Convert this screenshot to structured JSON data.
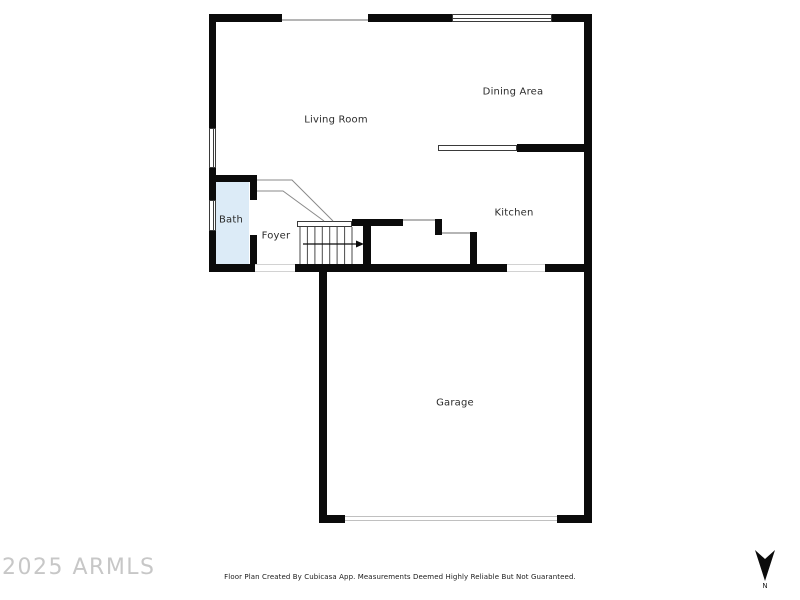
{
  "rooms": [
    {
      "label": "Living Room"
    },
    {
      "label": "Dining Area"
    },
    {
      "label": "Kitchen"
    },
    {
      "label": "Bath"
    },
    {
      "label": "Foyer"
    },
    {
      "label": "Garage"
    }
  ],
  "watermark": "2025 ARMLS",
  "disclaimer": "Floor Plan Created By Cubicasa App. Measurements Deemed Highly Reliable But Not Guaranteed.",
  "compass": {
    "label": "N"
  },
  "colors": {
    "wall": "#0b0b0b",
    "bath_fill": "#dcebf7"
  }
}
